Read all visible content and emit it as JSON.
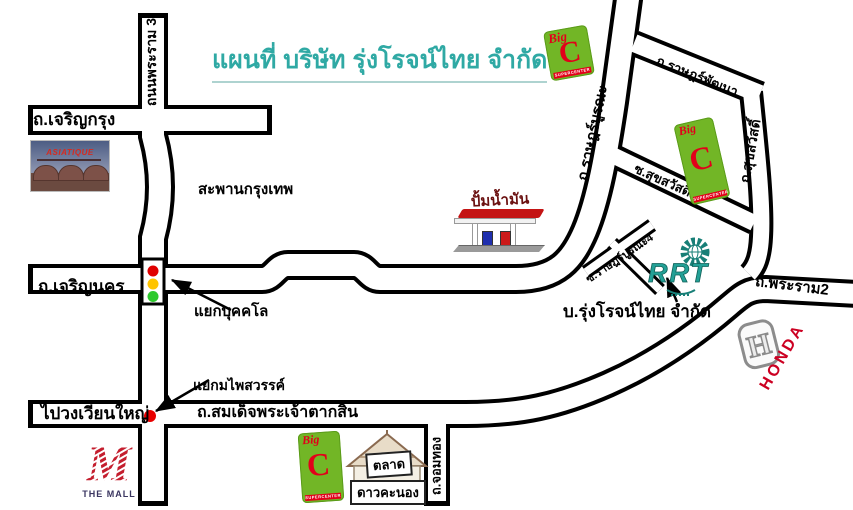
{
  "title": {
    "text": "แผนที่ บริษัท รุ่งโรจน์ไทย จำกัด"
  },
  "labels": {
    "roads": {
      "rama3": "ถนนพระราม 3",
      "charoen_krung": "ถ.เจริญกรุง",
      "charoen_nakhon": "ถ.เจริญนคร",
      "rat_burana": "ถ.ราษฎร์บูรณะ",
      "rat_pattana": "ถ.ราษฎร์พัฒนา",
      "soi_suksawat13": "ซ.สุขสวัสดิ์13",
      "suksawat": "ถ.สุขสวัสดิ์",
      "soi_rat_burana4": "ซ.ราษฎร์บูรณะ4",
      "rama2": "ถ.พระราม2",
      "taksin": "ถ.สมเด็จพระเจ้าตากสิน",
      "chomthong": "ถ.จอมทอง"
    },
    "places": {
      "saphan_krungthep": "สะพานกรุงเทพ",
      "yaek_bukkhalo": "แยกบุคคโล",
      "yaek_phaisawan": "แยกมไพสวรรค์",
      "wongwian_yai": "ไปวงเวียนใหญ่",
      "gas_station": "ปั้มน้ำมัน",
      "company": "บ.รุ่งโรจน์ไทย จำกัด"
    }
  },
  "logos": {
    "big_c": {
      "name": "Big",
      "letter": "C",
      "subtitle": "SUPERCENTER"
    },
    "rrt": {
      "letters": "RRT"
    },
    "honda": {
      "letter": "H",
      "text": "HONDA"
    },
    "the_mall": {
      "letter": "M",
      "text": "THE MALL"
    },
    "asiatique": {
      "text": "ASIATIQUE"
    },
    "market": {
      "line1": "ตลาด",
      "line2": "ดาวคะนอง"
    }
  },
  "colors": {
    "title_teal": "#2fa9a4",
    "road_outline": "#000000",
    "road_fill": "#ffffff",
    "big_c_green": "#72b626",
    "big_c_red": "#e2001a",
    "honda_red": "#cc0022",
    "rrt_teal": "#1f978c",
    "gas_label_red": "#6b1111",
    "traffic_red": "#e00000",
    "traffic_yellow": "#ffc400",
    "traffic_green": "#2ec92e",
    "intersection_dot_red": "#e80000",
    "mall_red": "#c41e2e"
  }
}
